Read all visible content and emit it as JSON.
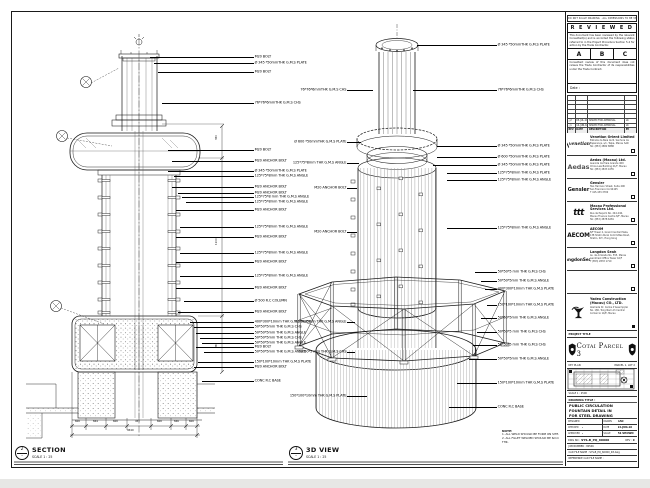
{
  "sheet": {
    "disclaimer": "DO NOT SCALE DRAWING · ALL DIMENSIONS TO BE VERIFIED ON SITE",
    "bottom_note": {
      "title": "NOTE:",
      "lines": [
        "1. ALL WELD SHOULD BE FORM ON SITE.",
        "2. ALL FILLET WELDED SHOULD BE 6mm THK."
      ]
    }
  },
  "reviewed": {
    "title": "R E V I E W E D",
    "para1": "This document has been reviewed by the relevant Consultant(s) and is accorded the following status referred to in the Project Procedure Section 5.4 for action by the Trade Contractor.",
    "options": [
      "A",
      "B",
      "C"
    ],
    "para2": "Consultant review of this document does not relieve the Trade Contractor of its responsibilities under the Trade Contract.",
    "date_label": "Date :"
  },
  "revisions": {
    "header": [
      "REV",
      "DATE",
      "DESCRIPTION",
      "BY"
    ],
    "empty_count": 5,
    "rows": [
      [
        "△2",
        "05-JUL-10",
        "ISSUED FOR APPROVAL",
        "LK"
      ],
      [
        "△1",
        "14-JUN-10",
        "ISSUED FOR APPROVAL",
        "LK"
      ]
    ]
  },
  "consultants": [
    {
      "logo": "venetian",
      "logo_text": "venetian",
      "name": "Venetian Orient Limited",
      "addr": [
        "Estrada da Baía de N. Senhora da",
        "Esperança, s/n, Taipa, Macau SAR",
        "Tel: (853) 2882 8888"
      ]
    },
    {
      "logo": "aedas",
      "logo_text": "Aedas",
      "name": "Aedas (Macau) Ltd.",
      "addr": [
        "Avenida da Praia Grande 409",
        "China Law Building 21/F, Macau",
        "Tel: (853) 2833 1055"
      ]
    },
    {
      "logo": "gensler",
      "logo_text": "Gensler",
      "name": "Gensler",
      "addr": [
        "Two Harrison Street, Suite 400",
        "San Francisco CA 94105",
        "T 415.433.3700"
      ]
    },
    {
      "logo": "mps",
      "logo_text": "ttt",
      "name": "Macau Professional Services Ltd.",
      "addr": [
        "Rua de Pequim No. 244-246,",
        "Macau Finance Centre 8/F, Macau",
        "Tel: (853) 2878 6281"
      ]
    },
    {
      "logo": "aecom",
      "logo_text": "AECOM",
      "name": "AECOM",
      "addr": [
        "8/F Tower 2, Grand Central Plaza,",
        "138 Shatin Rural Committee Road,",
        "Shatin, N.T., Hong Kong"
      ]
    },
    {
      "logo": "langdonseah",
      "logo_text": "LangdonSeah",
      "name": "Langdon Seah",
      "addr": [
        "Av. da Amizade No. 555, Macau",
        "Landmark Office Tower 16/F",
        "T (853) 2833 1710"
      ]
    }
  ],
  "contractor": {
    "name": "Yadea Construction",
    "name2": "(Macau) CO., LTD.",
    "addr": [
      "Alameda Dr. Carlos d'Assumpção",
      "No. 180, Tong Nam Ah Central",
      "Comércio 14/E, Macau"
    ]
  },
  "project": {
    "band": "PROJECT TITLE",
    "title": "Cotai Parcel 3"
  },
  "key_plan": {
    "band_left": "KEY PLAN",
    "band_right": "PARCEL 1, LOT 2",
    "footer": "SCALE  1 : 2500"
  },
  "title_block": {
    "label": "DRAWING TITLE :",
    "title_lines": [
      "PUBLIC CIRCULATION",
      "FOUNTAIN DETAIL IN",
      "FOR STEEL DRAWING"
    ],
    "fields": [
      {
        "l": "DESIGNED",
        "lv": "",
        "r": "DRAWN",
        "rv": "CAD"
      },
      {
        "l": "CHECKED",
        "lv": "-",
        "r": "DATE",
        "rv": "14-JUN-10"
      },
      {
        "l": "APPROVED",
        "lv": "-",
        "r": "SCALE",
        "rv": "AS SHOWN"
      }
    ],
    "dwg_label": "DWG NO :",
    "dwg_no": "SYS-B_PQ_60000",
    "rev_label": "REV :",
    "rev": "C",
    "job": "JOB NUMBER : 80546",
    "cad": "CAD FILE NAME : SYS-B_PQ_60000_R3.dwg",
    "ref": "REFERENCE CAD FILE NAME :"
  },
  "views": {
    "section": {
      "tag": "2",
      "tag2": "-",
      "title": "SECTION",
      "scale": "SCALE 1 : 25",
      "labels": [
        [
          57,
          104,
          "M20 BOLT"
        ],
        [
          63,
          100,
          "Ø 345 *50mmTHK G.M.S PLATE"
        ],
        [
          72,
          96,
          "M20 BOLT"
        ],
        [
          103,
          92,
          "76*76*6mmTHK G.M.S CHS"
        ],
        [
          150,
          86,
          "M20 BOLT"
        ],
        [
          161,
          82,
          "M20 ANCHOR BOLT"
        ],
        [
          171,
          86,
          "Ø 345 *50mmTHK G.M.S PLATE"
        ],
        [
          176,
          80,
          "125*75*8mm THK G.M.S ANGLE"
        ],
        [
          187,
          82,
          "M20 ANCHOR BOLT"
        ],
        [
          193,
          76,
          "M20 ANCHOR BOLT"
        ],
        [
          197,
          72,
          "125*75*8 mm THK G.M.S ANGLE"
        ],
        [
          202,
          68,
          "125*75*8mm THK G.M.S ANGLE"
        ],
        [
          210,
          78,
          "M20 ANCHOR BOLT"
        ],
        [
          227,
          74,
          "125*75*8mm THK G.M.S ANGLE"
        ],
        [
          237,
          78,
          "M20 ANCHOR BOLT"
        ],
        [
          253,
          74,
          "125*75*8mm THK G.M.S ANGLE"
        ],
        [
          262,
          78,
          "M20 ANCHOR BOLT"
        ],
        [
          276,
          74,
          "125*75*8mm THK G.M.S ANGLE"
        ],
        [
          288,
          78,
          "M20 ANCHOR BOLT"
        ],
        [
          301,
          70,
          "Ø 500 R.C COLUMN"
        ],
        [
          312,
          76,
          "M20 ANCHOR BOLT"
        ],
        [
          322,
          64,
          "400*300*10mm THK G.M.S PLATE"
        ],
        [
          327,
          60,
          "50*50*5mm THK G.M.S CHS"
        ],
        [
          333,
          58,
          "50*50*5mm THK G.M.S ANGLE"
        ],
        [
          338,
          54,
          "50*50*5mm THK G.M.S CHS"
        ],
        [
          343,
          52,
          "50*50*5mm THK G.M.S ANGLE"
        ],
        [
          347,
          58,
          "M20 BOLT"
        ],
        [
          352,
          50,
          "50*50*5mm THK G.M.S ANGLE"
        ],
        [
          362,
          56,
          "150*100*10mm THK G.M.S PLATE"
        ],
        [
          367,
          60,
          "M20 ANCHOR BOLT"
        ],
        [
          381,
          52,
          "CONC R.C BASE"
        ]
      ],
      "dim_labels": [
        [
          75,
          421,
          "600"
        ],
        [
          93,
          421,
          "844"
        ],
        [
          113,
          421,
          "600"
        ],
        [
          135,
          421,
          "450"
        ],
        [
          157,
          421,
          "600"
        ],
        [
          174,
          421,
          "846"
        ],
        [
          189,
          421,
          "600"
        ],
        [
          127,
          429.5,
          "4540"
        ],
        [
          216,
          245,
          "1100",
          "v"
        ],
        [
          216,
          348,
          "950",
          "v"
        ],
        [
          216,
          140,
          "350",
          "v"
        ]
      ]
    },
    "iso": {
      "tag": "3",
      "tag2": "-",
      "title": "3D VIEW",
      "scale": "SCALE 1 : 25",
      "right_labels": [
        [
          45,
          80,
          "Ø 345 *50mmTHK G.M.S PLATE"
        ],
        [
          90,
          84,
          "76*76*6mmTHK G.M.S CHS"
        ],
        [
          146,
          60,
          "Ø 345 *50mmTHK G.M.S PLATE"
        ],
        [
          157,
          60,
          "Ø 600 *50mmTHK G.M.S PLATE"
        ],
        [
          165,
          64,
          "Ø 345 *50mmTHK G.M.S PLATE"
        ],
        [
          173,
          50,
          "125*75*8mm THK G.M.S PLATE"
        ],
        [
          180,
          50,
          "125*75*8mm THK G.M.S ANGLE"
        ],
        [
          228,
          50,
          "125*75*8mm THK G.M.S ANGLE"
        ],
        [
          272,
          22,
          "50*50*5 mm THK G.M.S CHS"
        ],
        [
          281,
          16,
          "50*50*5mm THK G.M.S ANGLE"
        ],
        [
          289,
          12,
          "400*300*10mm THK G.M.S PLATE"
        ],
        [
          305,
          10,
          "150*100*10mm THK G.M.S PLATE"
        ],
        [
          318,
          16,
          "50*50*5mm THK G.M.S ANGLE"
        ],
        [
          332,
          20,
          "50*50*5 mm THK G.M.S CHS"
        ],
        [
          345,
          24,
          "50*50*5 mm THK G.M.S CHS"
        ],
        [
          359,
          28,
          "50*50*5mm THK G.M.S ANGLE"
        ],
        [
          383,
          40,
          "150*100*10mm THK G.M.S PLATE"
        ],
        [
          407,
          48,
          "CONC R.C BASE"
        ]
      ],
      "left_labels": [
        [
          90,
          26,
          "76*76*6mmTHK G.M.S CHS"
        ],
        [
          142,
          14,
          "Ø 600 *50mmTHK G.M.S PLATE"
        ],
        [
          163,
          12,
          "125*75*8mm THK G.M.S ANGLE"
        ],
        [
          188,
          10,
          "M20 ANCHOR BOLT"
        ],
        [
          232,
          10,
          "M20 ANCHOR BOLT"
        ],
        [
          322,
          8,
          "50*50*5mm THK G.M.S ANGLE"
        ],
        [
          352,
          8,
          "50*50*5 mm THK G.M.S CHS"
        ],
        [
          396,
          20,
          "150*100*10mm THK G.M.S PLATE"
        ]
      ]
    }
  }
}
